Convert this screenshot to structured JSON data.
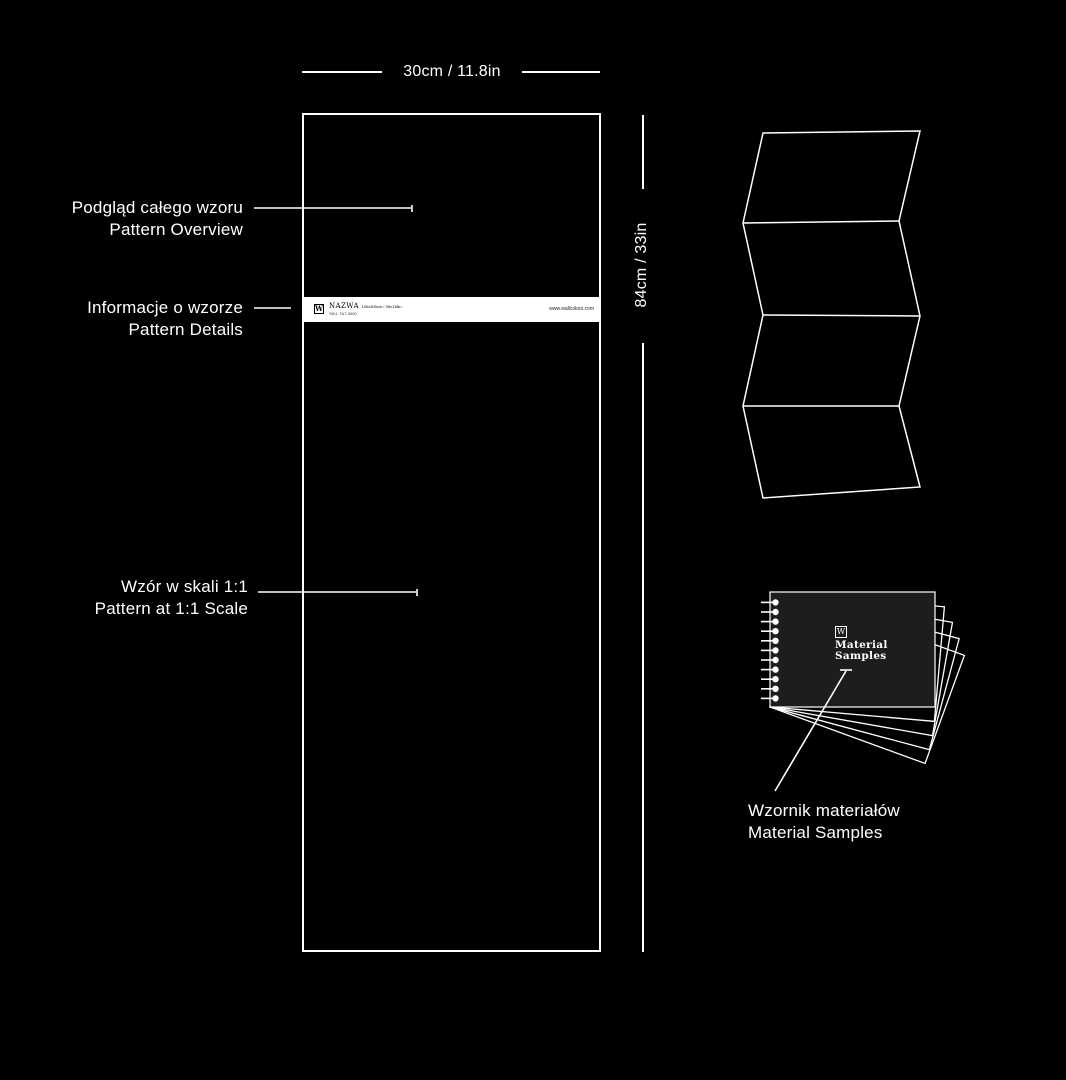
{
  "colors": {
    "background": "#000000",
    "line": "#ffffff",
    "strip_background": "#ffffff",
    "book_cover": "#1d1d1d"
  },
  "dimensions": {
    "width_label": "30cm / 11.8in",
    "height_label": "84cm / 33in"
  },
  "annotations": {
    "overview": {
      "pl": "Podgląd całego wzoru",
      "en": "Pattern Overview"
    },
    "details": {
      "pl": "Informacje o wzorze",
      "en": "Pattern Details"
    },
    "scale": {
      "pl": "Wzór w skali 1:1",
      "en": "Pattern at 1:1 Scale"
    },
    "samples": {
      "pl": "Wzornik materiałów",
      "en": "Material Samples"
    }
  },
  "sample_sheet": {
    "info_strip": {
      "logo": "W",
      "name": "NAZWA",
      "size": "100x300cm / 39x118in",
      "sku": "SKU: TA7-0000",
      "website": "www.wallcolors.com"
    }
  },
  "swatch_book": {
    "logo": "W",
    "title": {
      "line1": "Material",
      "line2": "Samples"
    }
  }
}
